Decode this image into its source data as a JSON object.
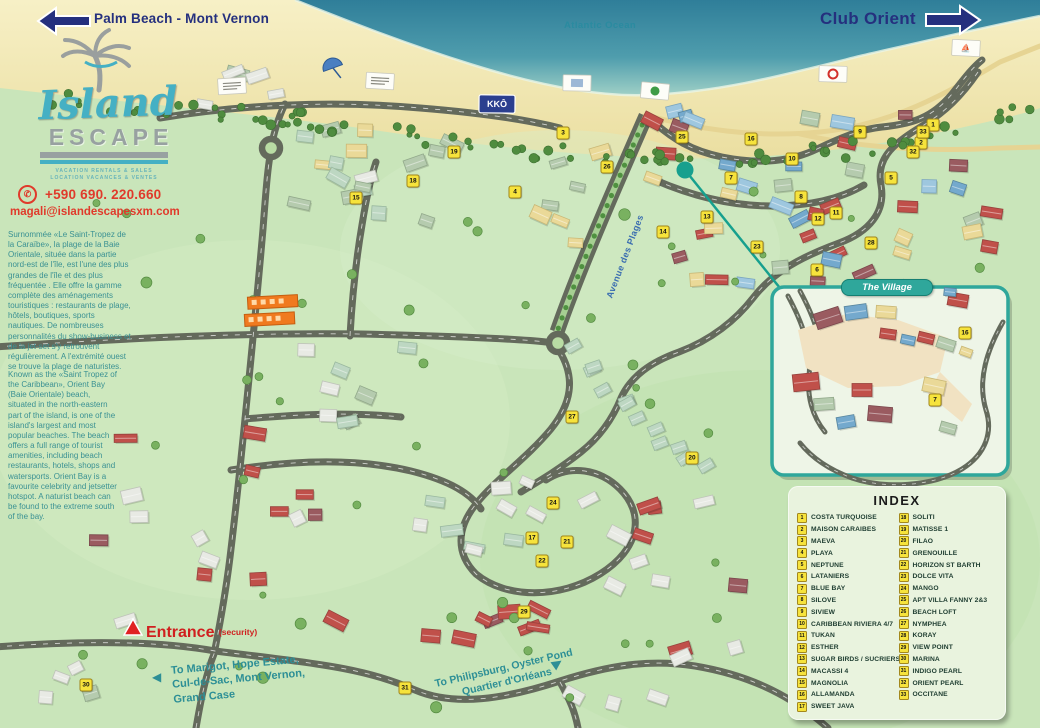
{
  "header": {
    "left_destination": "Palm Beach - Mont Vernon",
    "right_destination": "Club Orient",
    "ocean_label": "Atlantic Ocean"
  },
  "brand": {
    "logo_line1": "Island",
    "logo_line2": "ESCAPE",
    "tagline1": "VACATION RENTALS & SALES",
    "tagline2": "LOCATION VACANCES & VENTES",
    "phone": "+590 690. 220.660",
    "email": "magali@islandescapesxm.com"
  },
  "intro_fr": "Surnommée «Le Saint-Tropez de la Caraïbe», la plage de la Baie Orientale, située dans la partie nord-est de l'île, est l'une des plus grandes de l'île et des plus fréquentée . Elle offre la gamme complète des aménagements touristiques : restaurants de plage, hôtels, boutiques, sports nautiques. De nombreuses personnalités du show-business et de la jet-set s'y retrouvent régulièrement. A l'extrémité ouest se trouve la plage de naturistes.",
  "intro_en": "Known as the «Saint Tropez of the Caribbean», Orient Bay (Baie Orientale) beach, situated in the north-eastern part of the island, is one of the island's largest and most popular beaches. The beach offers a full range of tourist amenities, including beach restaurants, hotels, shops and watersports. Orient Bay is a favourite celebrity and jetsetter hotspot. A naturist beach can be found to the extreme south of the bay.",
  "map_labels": {
    "avenue": "Avenue des Plages",
    "entrance": "Entrance",
    "entrance_note": "(security)",
    "to_marigot": "To Marigot, Hope Estate,\nCul-de-Sac, Mont Vernon,\nGrand Case",
    "to_philipsburg_line1": "To Philipsburg, Oyster Pond",
    "to_philipsburg_line2": "Quartier d'Orléans",
    "village_title": "The Village",
    "kko_sign": "KKÔ",
    "left_arrow": "◀",
    "right_arrow": "▶"
  },
  "index": {
    "title": "INDEX",
    "entries": [
      {
        "n": 1,
        "label": "COSTA TURQUOISE"
      },
      {
        "n": 2,
        "label": "MAISON CARAIBES"
      },
      {
        "n": 3,
        "label": "MAEVA"
      },
      {
        "n": 4,
        "label": "PLAYA"
      },
      {
        "n": 5,
        "label": "NEPTUNE"
      },
      {
        "n": 6,
        "label": "LATANIERS"
      },
      {
        "n": 7,
        "label": "BLUE BAY"
      },
      {
        "n": 8,
        "label": "SILOVE"
      },
      {
        "n": 9,
        "label": "SIVIEW"
      },
      {
        "n": 10,
        "label": "CARIBBEAN RIVIERA 4/7"
      },
      {
        "n": 11,
        "label": "TUKAN"
      },
      {
        "n": 12,
        "label": "ESTHER"
      },
      {
        "n": 13,
        "label": "SUGAR BIRDS / SUCRIERS"
      },
      {
        "n": 14,
        "label": "MACASSI 4"
      },
      {
        "n": 15,
        "label": "MAGNOLIA"
      },
      {
        "n": 16,
        "label": "ALLAMANDA"
      },
      {
        "n": 17,
        "label": "SWEET JAVA"
      },
      {
        "n": 18,
        "label": "SOLITI"
      },
      {
        "n": 19,
        "label": "MATISSE 1"
      },
      {
        "n": 20,
        "label": "FILAO"
      },
      {
        "n": 21,
        "label": "GRENOUILLE"
      },
      {
        "n": 22,
        "label": "HORIZON ST BARTH"
      },
      {
        "n": 23,
        "label": "DOLCE VITA"
      },
      {
        "n": 24,
        "label": "MANGO"
      },
      {
        "n": 25,
        "label": "APT VILLA FANNY 2&3"
      },
      {
        "n": 26,
        "label": "BEACH LOFT"
      },
      {
        "n": 27,
        "label": "NYMPHEA"
      },
      {
        "n": 28,
        "label": "KORAY"
      },
      {
        "n": 29,
        "label": "VIEW POINT"
      },
      {
        "n": 30,
        "label": "MARINA"
      },
      {
        "n": 31,
        "label": "INDIGO PEARL"
      },
      {
        "n": 32,
        "label": "ORIENT PEARL"
      },
      {
        "n": 33,
        "label": "OCCITANE"
      }
    ]
  },
  "markers": [
    {
      "n": 1,
      "x": 933,
      "y": 125
    },
    {
      "n": 2,
      "x": 921,
      "y": 143
    },
    {
      "n": 3,
      "x": 563,
      "y": 133
    },
    {
      "n": 4,
      "x": 515,
      "y": 192
    },
    {
      "n": 5,
      "x": 891,
      "y": 178
    },
    {
      "n": 6,
      "x": 817,
      "y": 270
    },
    {
      "n": 7,
      "x": 731,
      "y": 178
    },
    {
      "n": 8,
      "x": 801,
      "y": 197
    },
    {
      "n": 9,
      "x": 860,
      "y": 132
    },
    {
      "n": 10,
      "x": 792,
      "y": 159
    },
    {
      "n": 11,
      "x": 836,
      "y": 213
    },
    {
      "n": 12,
      "x": 818,
      "y": 219
    },
    {
      "n": 13,
      "x": 707,
      "y": 217
    },
    {
      "n": 14,
      "x": 663,
      "y": 232
    },
    {
      "n": 15,
      "x": 356,
      "y": 198
    },
    {
      "n": 16,
      "x": 751,
      "y": 139
    },
    {
      "n": 17,
      "x": 532,
      "y": 538
    },
    {
      "n": 18,
      "x": 413,
      "y": 181
    },
    {
      "n": 19,
      "x": 454,
      "y": 152
    },
    {
      "n": 20,
      "x": 692,
      "y": 458
    },
    {
      "n": 21,
      "x": 567,
      "y": 542
    },
    {
      "n": 22,
      "x": 542,
      "y": 561
    },
    {
      "n": 23,
      "x": 757,
      "y": 247
    },
    {
      "n": 24,
      "x": 553,
      "y": 503
    },
    {
      "n": 25,
      "x": 682,
      "y": 137
    },
    {
      "n": 26,
      "x": 607,
      "y": 167
    },
    {
      "n": 27,
      "x": 572,
      "y": 417
    },
    {
      "n": 28,
      "x": 871,
      "y": 243
    },
    {
      "n": 29,
      "x": 524,
      "y": 612
    },
    {
      "n": 30,
      "x": 86,
      "y": 685
    },
    {
      "n": 31,
      "x": 405,
      "y": 688
    },
    {
      "n": 32,
      "x": 913,
      "y": 152
    },
    {
      "n": 33,
      "x": 923,
      "y": 132
    }
  ],
  "village_markers": [
    {
      "n": 16,
      "x": 965,
      "y": 333
    },
    {
      "n": 7,
      "x": 935,
      "y": 400
    }
  ],
  "beach_signs": [
    {
      "x": 232,
      "y": 86,
      "type": "menu"
    },
    {
      "x": 380,
      "y": 81,
      "type": "menu"
    },
    {
      "x": 497,
      "y": 104,
      "type": "kko"
    },
    {
      "x": 577,
      "y": 83,
      "type": "plain"
    },
    {
      "x": 655,
      "y": 91,
      "type": "tree"
    },
    {
      "x": 833,
      "y": 74,
      "type": "red-dot"
    },
    {
      "x": 966,
      "y": 48,
      "type": "red-1"
    }
  ],
  "colors": {
    "navy": "#25307e",
    "teal_text": "#3a9193",
    "red_text": "#e03a2b",
    "entrance_red": "#d01f1f",
    "marker_yellow": "#f6e33c",
    "village_teal": "#2fa79b",
    "road_gray": "#646a5c",
    "ocean": "#2f7e99",
    "sand": "#f3ebba",
    "land": "#c9e5ba",
    "index_bg": "#e9f3de"
  }
}
